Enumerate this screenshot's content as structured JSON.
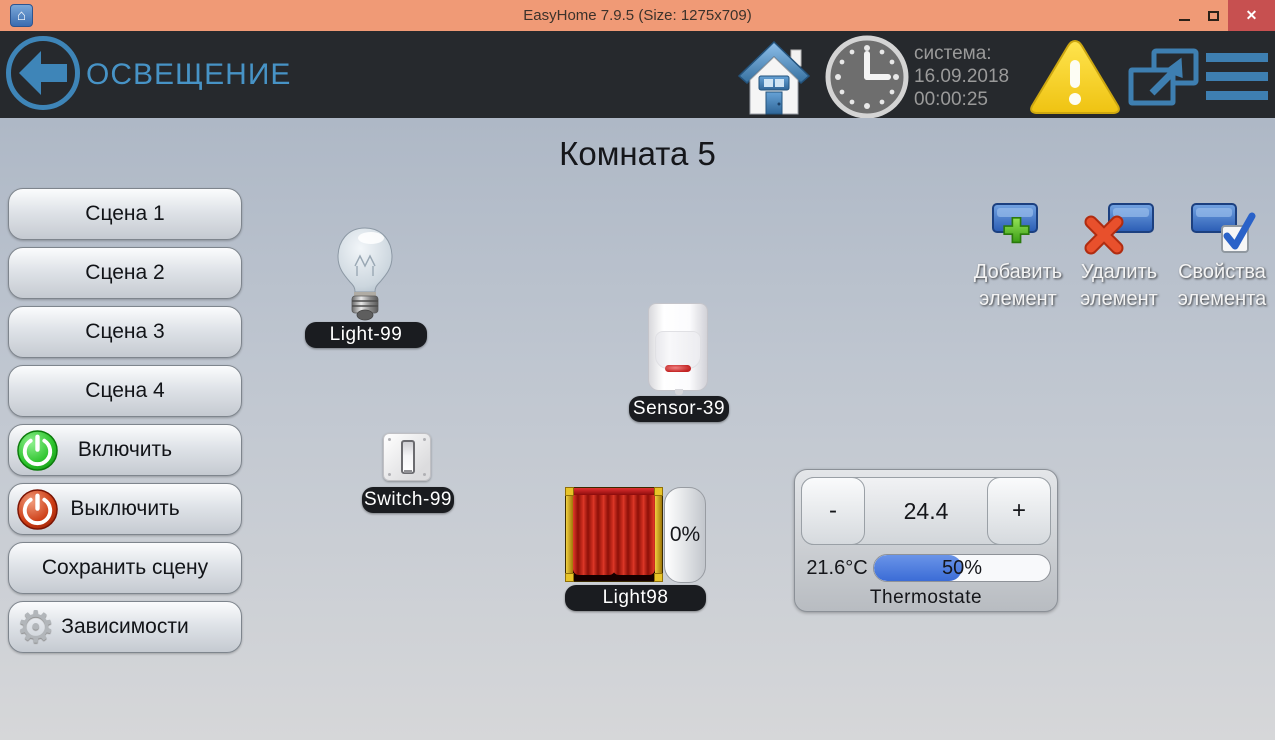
{
  "window": {
    "title": "EasyHome 7.9.5 (Size: 1275x709)"
  },
  "header": {
    "section_title": "ОСВЕЩЕНИЕ",
    "system_label": "система:",
    "system_date": "16.09.2018",
    "system_time": "00:00:25"
  },
  "room": {
    "title": "Комната 5"
  },
  "sidebar": {
    "buttons": [
      {
        "label": "Сцена 1"
      },
      {
        "label": "Сцена 2"
      },
      {
        "label": "Сцена 3"
      },
      {
        "label": "Сцена 4"
      },
      {
        "label": "Включить",
        "icon": "power-on-icon"
      },
      {
        "label": "Выключить",
        "icon": "power-off-icon"
      },
      {
        "label": "Сохранить сцену"
      },
      {
        "label": "Зависимости",
        "icon": "gear-icon"
      }
    ]
  },
  "actions": {
    "add": {
      "line1": "Добавить",
      "line2": "элемент"
    },
    "delete": {
      "line1": "Удалить",
      "line2": "элемент"
    },
    "properties": {
      "line1": "Свойства",
      "line2": "элемента"
    }
  },
  "devices": {
    "light99": {
      "label": "Light-99"
    },
    "sensor39": {
      "label": "Sensor-39"
    },
    "switch99": {
      "label": "Switch-99"
    },
    "light98": {
      "label": "Light98",
      "level": "0%"
    },
    "thermostat": {
      "label": "Thermostate",
      "minus": "-",
      "plus": "+",
      "setpoint": "24.4",
      "current_temp": "21.6°C",
      "humidity": "50%",
      "progress_width": "50%"
    }
  },
  "icons": {
    "app_house_glyph": "⌂",
    "close_glyph": "✕",
    "gear_glyph": "⚙"
  },
  "colors": {
    "titlebar": "#f09a76",
    "close_button": "#c75050",
    "header_bg": "#26292d",
    "accent_blue": "#3e7fb1",
    "title_text_blue": "#4793c6",
    "warning_yellow": "#f5d327",
    "progress_blue": "#3b6cd6",
    "pill_bg": "#1a1c20"
  }
}
